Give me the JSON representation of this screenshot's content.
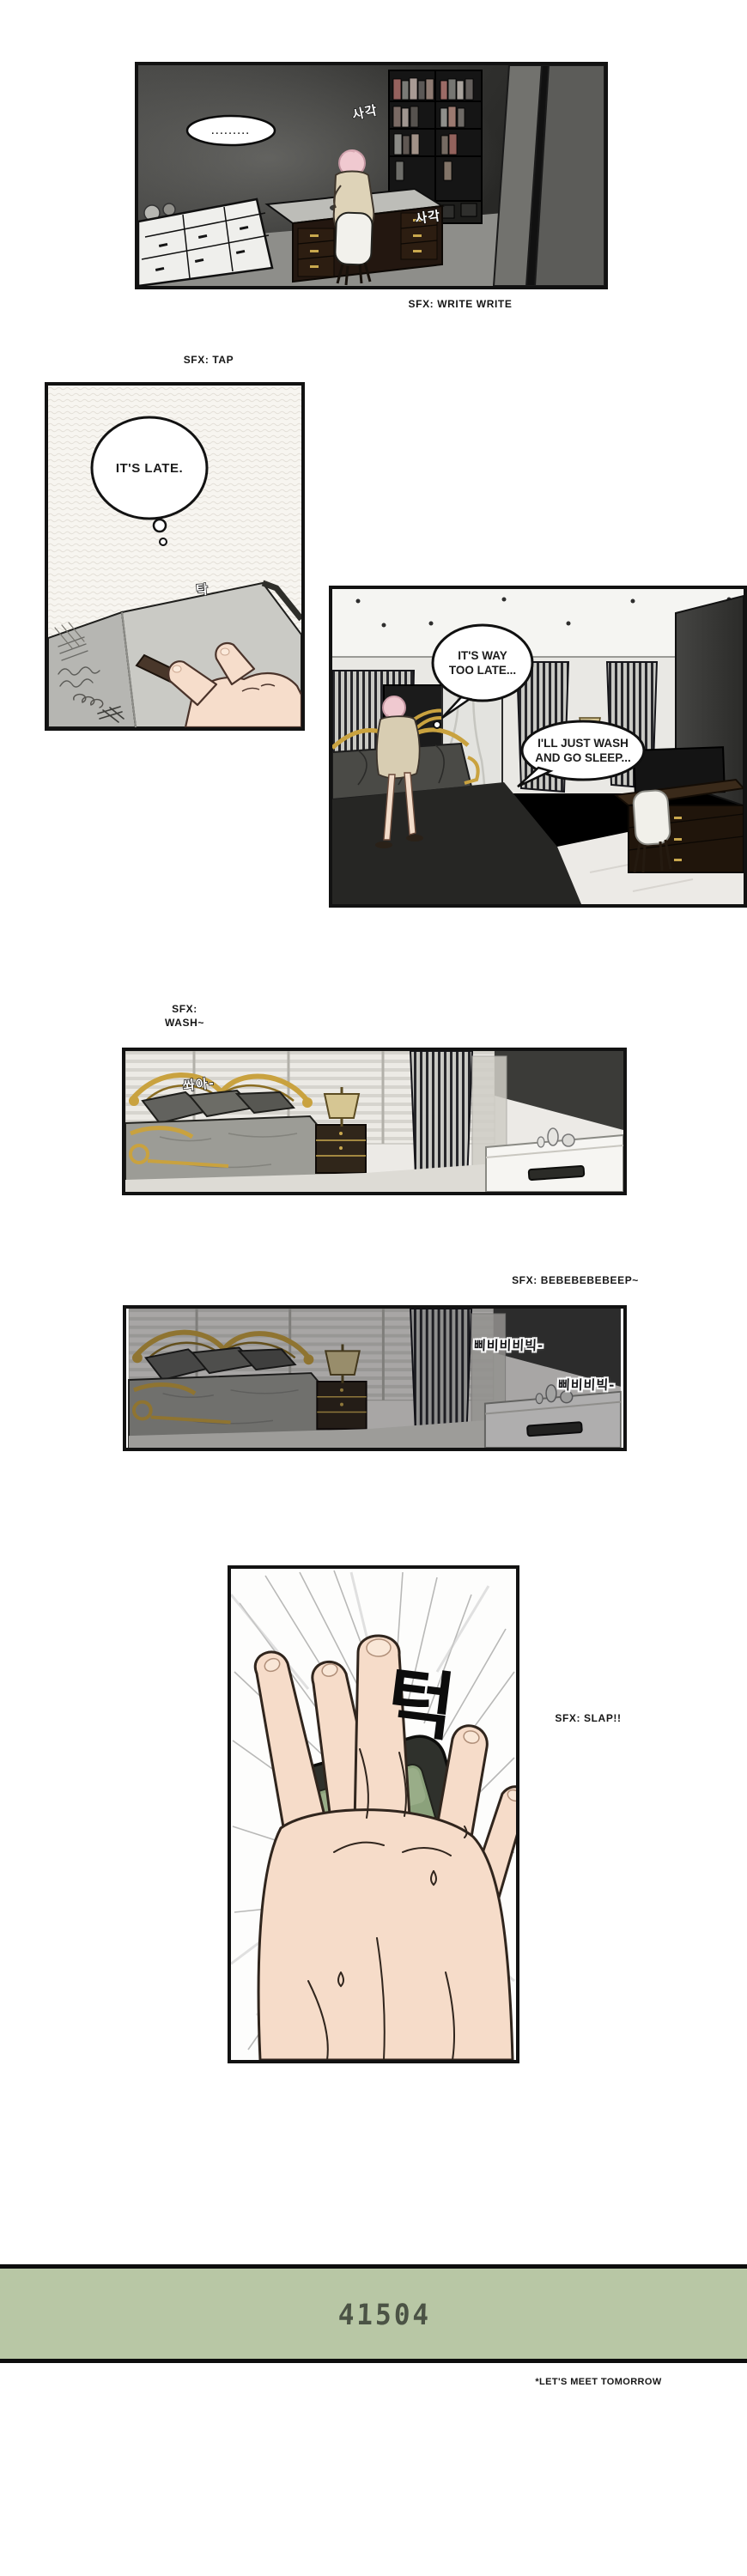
{
  "colors": {
    "page_bg": "#ffffff",
    "panel_border": "#121212",
    "clock_bg": "#b8c7a5",
    "clock_digits": "#4b5345",
    "gold_accent": "#c9a23f",
    "skin": "#f6ddca",
    "alarm_screen_green": "#8ba17b"
  },
  "captions": {
    "write": "SFX: WRITE WRITE",
    "tap": "SFX: TAP",
    "wash_line1": "SFX:",
    "wash_line2": "WASH~",
    "beep": "SFX: BEBEBEBEBEEP~",
    "slap": "SFX: SLAP!!"
  },
  "panel1": {
    "bubble": ".........",
    "sfx_kr_1": "사각",
    "sfx_kr_2": "사각"
  },
  "panel2": {
    "thought": "IT'S LATE.",
    "sfx_kr": "탁"
  },
  "panel3": {
    "bubble1_line1": "IT'S WAY",
    "bubble1_line2": "TOO LATE...",
    "bubble2_line1": "I'LL JUST WASH",
    "bubble2_line2": "AND GO SLEEP..."
  },
  "panel4": {
    "sfx_kr": "쏴아-"
  },
  "panel5": {
    "sfx_kr_bubble1": "삐비비비빅-",
    "sfx_kr_bubble2": "삐비비빅-"
  },
  "panel6": {
    "sfx_kr": "턱"
  },
  "clock": {
    "display": "41504",
    "footnote": "*LET'S MEET TOMORROW"
  }
}
